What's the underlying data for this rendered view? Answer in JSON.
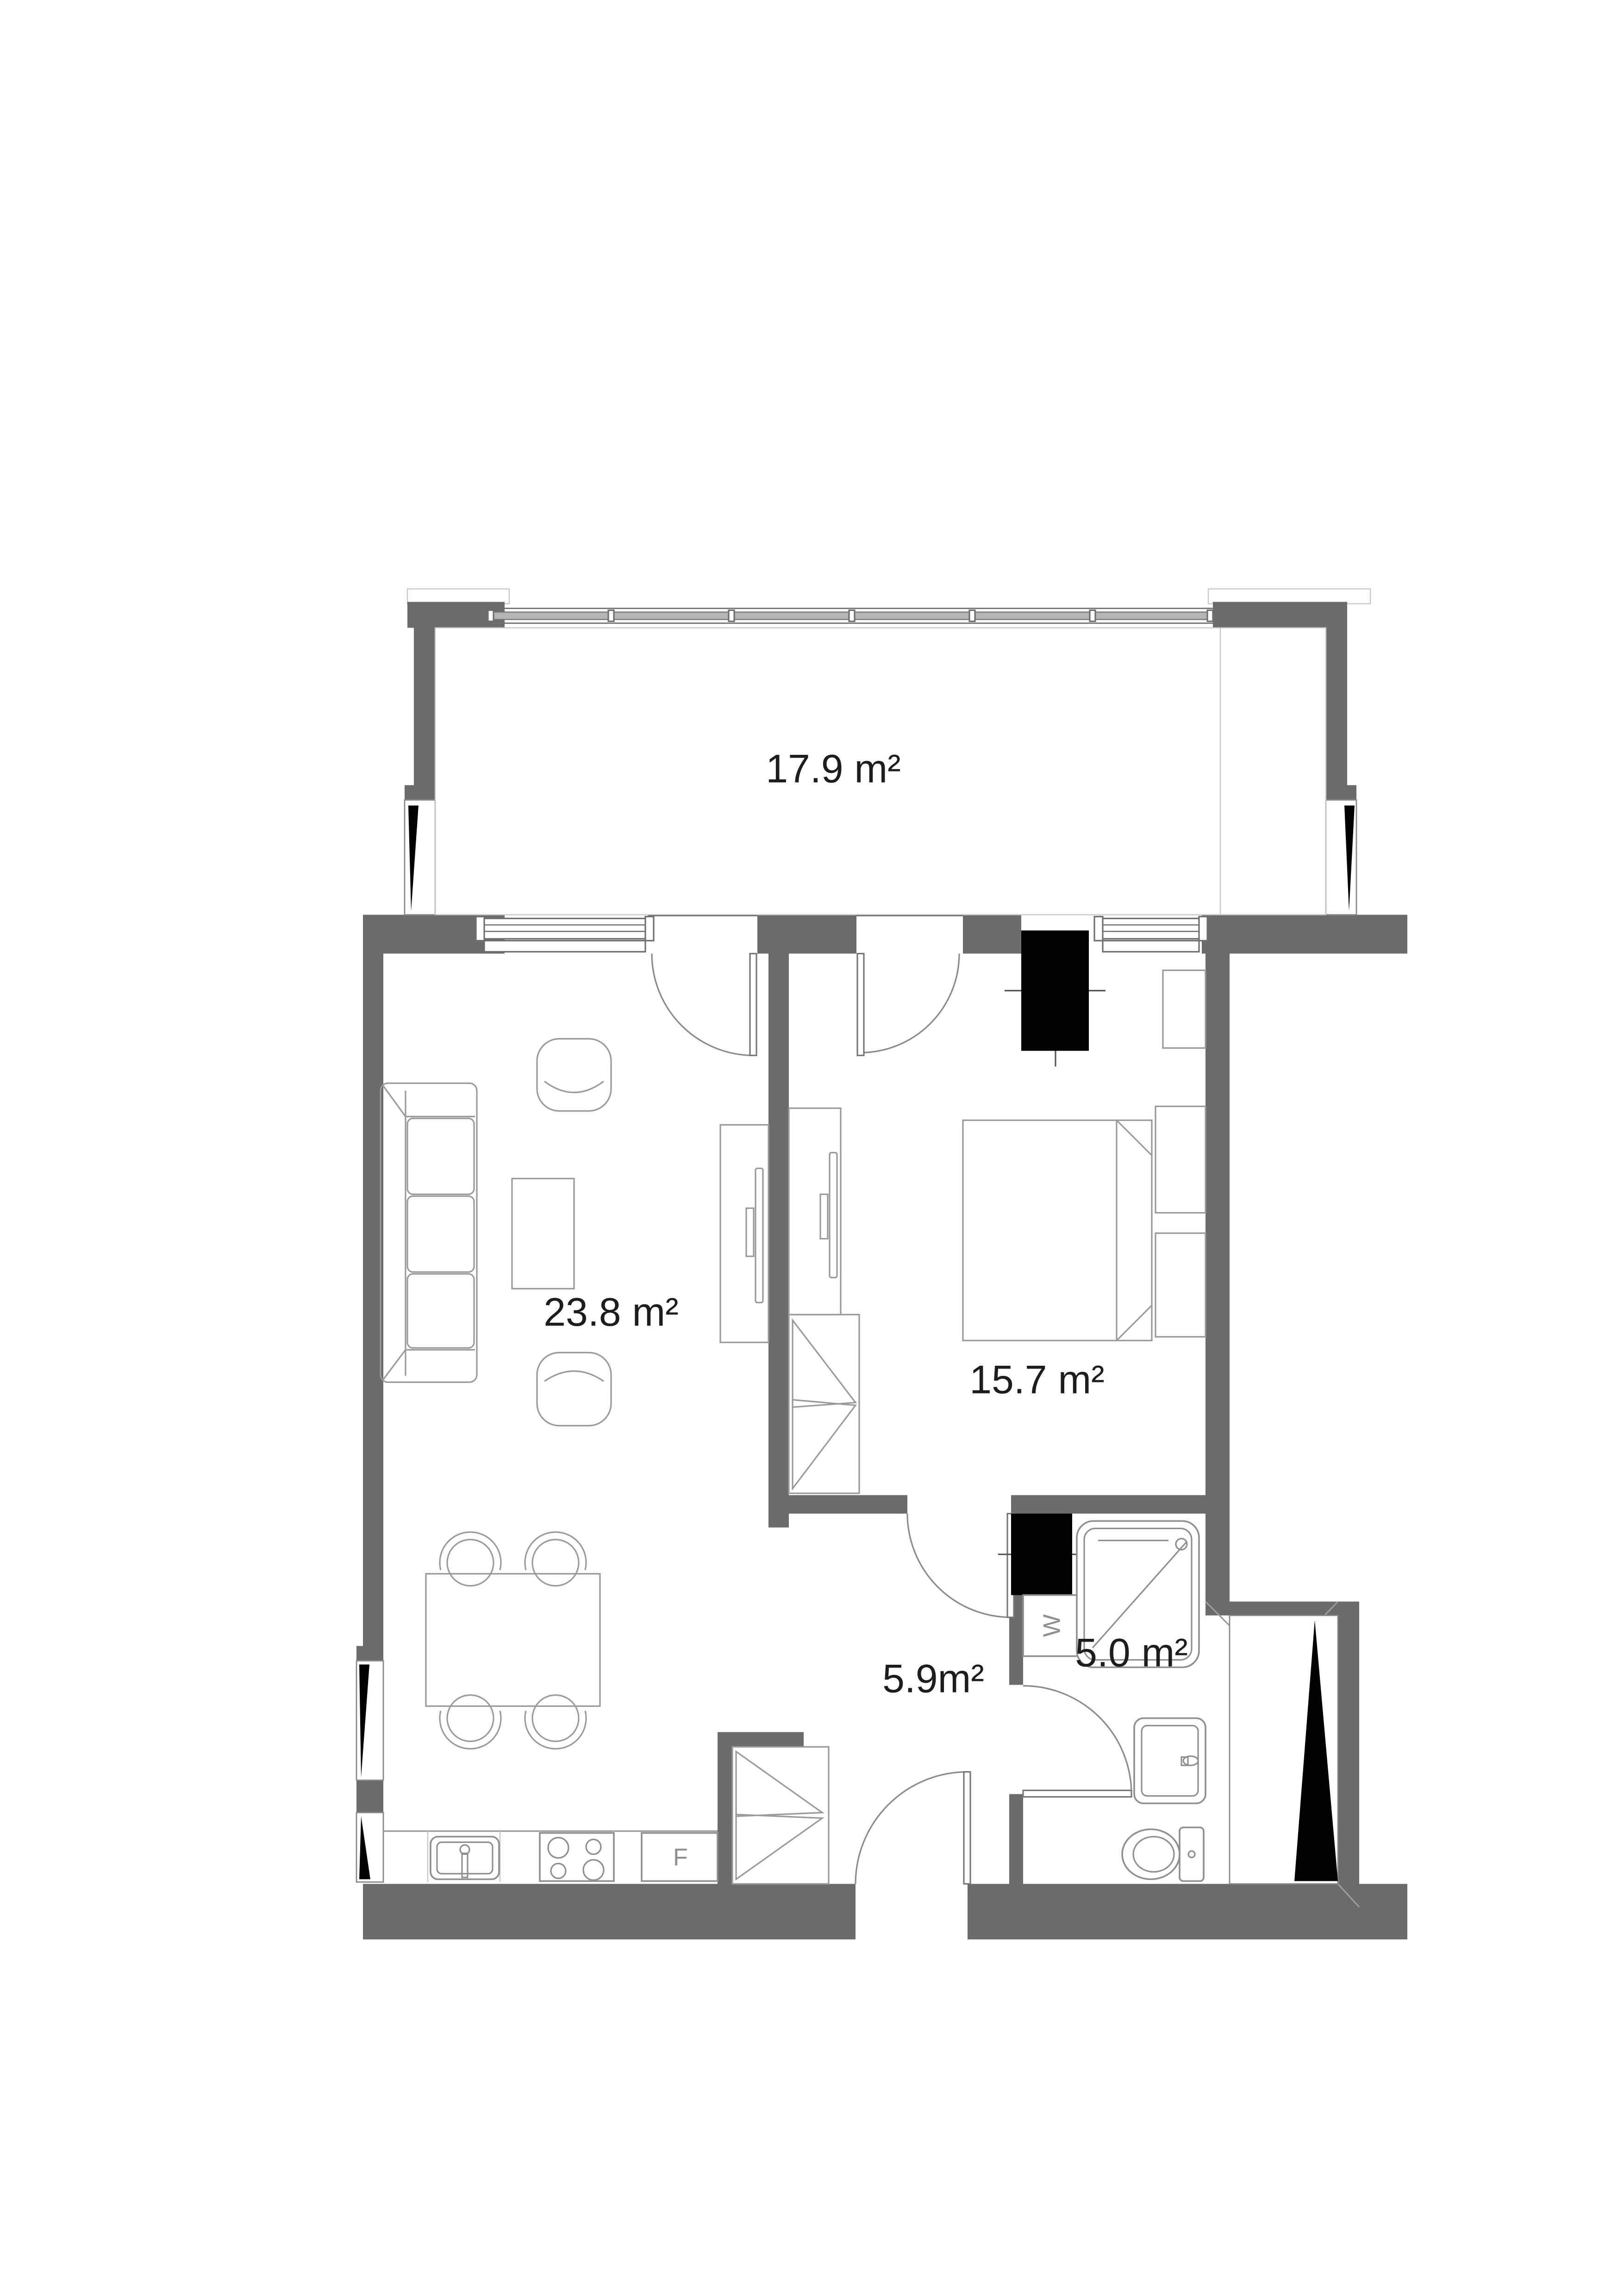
{
  "document": {
    "type": "apartment floor plan",
    "background": "#ffffff"
  },
  "rooms": {
    "balcony": {
      "area_label": "17.9 m²"
    },
    "living_room": {
      "area_label": "23.8 m²"
    },
    "bedroom": {
      "area_label": "15.7 m²"
    },
    "bathroom": {
      "area_label": "5.0 m²"
    },
    "hallway": {
      "area_label": "5.9m²"
    }
  },
  "appliances": {
    "washing_machine_label": "W",
    "fridge_label": "F"
  },
  "colors": {
    "wall": "#6b6b6b",
    "furniture_line": "#9a9a9a",
    "fixture_line": "#8f8f8f",
    "shaft_fill": "#000000",
    "label_text": "#1d1d1d",
    "appliance_text": "#8f8f8f"
  }
}
